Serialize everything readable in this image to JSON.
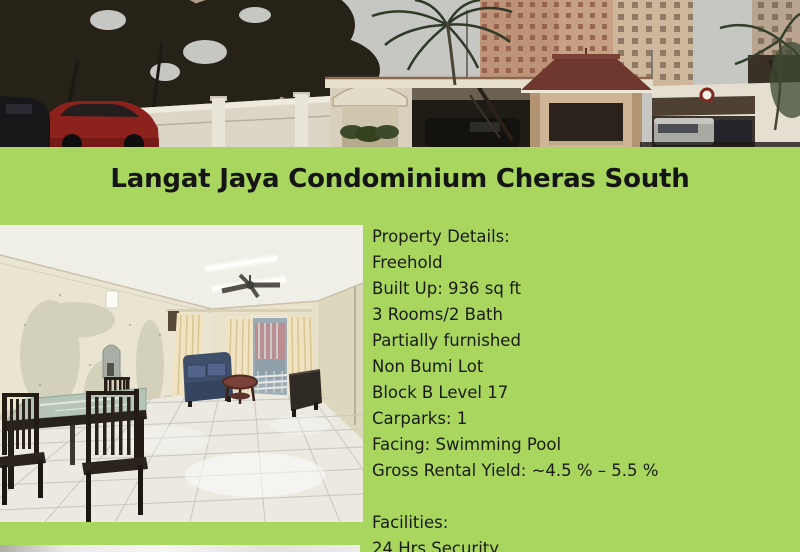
{
  "colors": {
    "background_green": "#a8d65e",
    "title_text": "#151515",
    "body_text": "#1a1a16"
  },
  "title": "Langat Jaya Condominium Cheras South",
  "details": {
    "heading": "Property Details:",
    "lines": [
      "Freehold",
      "Built Up: 936 sq ft",
      "3 Rooms/2 Bath",
      "Partially furnished",
      "Non Bumi Lot",
      "Block B Level 17",
      "Carparks: 1",
      "Facing: Swimming Pool",
      "Gross Rental Yield: ~4.5 % – 5.5 %"
    ]
  },
  "facilities": {
    "heading": "Facilities:",
    "items": [
      "24 Hrs Security"
    ]
  },
  "photos": {
    "hero": "condominium entrance street view with guard house and palm trees",
    "interior": "partially furnished living and dining room with white tiled floor",
    "bottom": "top edge of next photo (cropped)"
  }
}
